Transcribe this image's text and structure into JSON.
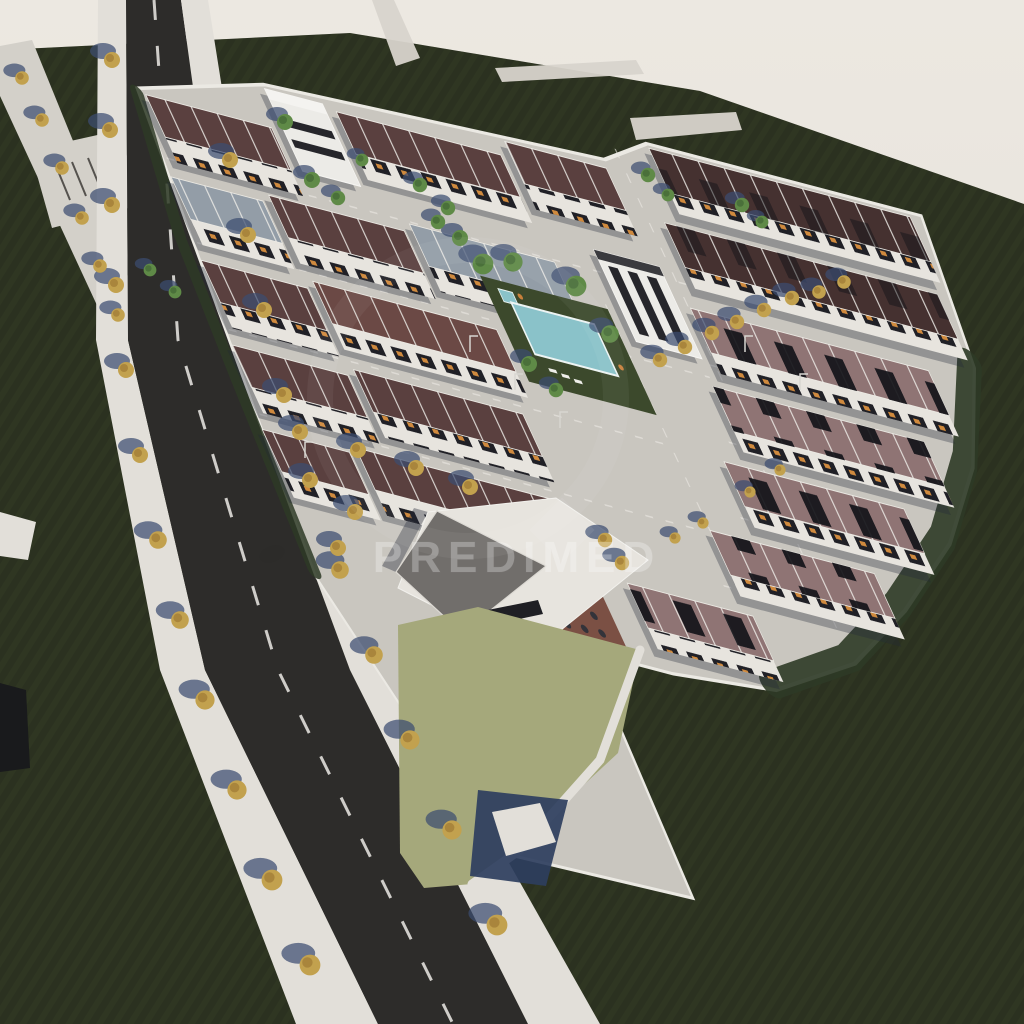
{
  "scene": {
    "kind": "aerial-3d-architectural-render",
    "subject": "residential urbanization with townhouse rows, central swimming pool, commercial building with terrace, tree-lined avenue and surrounding dark green fields",
    "watermark": {
      "text": "PREDIMED"
    }
  },
  "palette": {
    "sky_top": "#ece8e1",
    "sky_bottom": "#e3ded6",
    "field": "#2b3120",
    "field_stripe": "#3a4129",
    "strip_light": "#d8d4cc",
    "road_light": "#d3d0c9",
    "sidewalk": "#e2dfd9",
    "asphalt": "#2d2c2a",
    "dash": "#eceae5",
    "base": "#c9c6bf",
    "base_edge": "#ebe9e3",
    "hedge": "#2e3a26",
    "wall": "#e7e4de",
    "dark_band": "#26262b",
    "white_bldg": "#ecebe7",
    "roof_maroon": "#5a403f",
    "roof_maroon_dark": "#453130",
    "roof_mauve": "#8f7474",
    "roof_slate": "#939da7",
    "roof_brown": "#6b4945",
    "pool_lawn": "#3c492c",
    "pool_water": "#8ac2c9",
    "lawn_olive": "#a5a87b",
    "patio_brown": "#7b5044",
    "table_dark": "#33333a",
    "commercial_roof": "#716e6b",
    "blue_wedge": "#2e3e5e",
    "tree_green": "#5f8a47",
    "tree_green_dark": "#4a703a",
    "tree_autumn": "#c2a14e",
    "tree_autumn_dark": "#a9853c",
    "shadow_blue": "#3b4c70",
    "block_shadow": "#232838",
    "watermark_color": "#ffffff"
  }
}
